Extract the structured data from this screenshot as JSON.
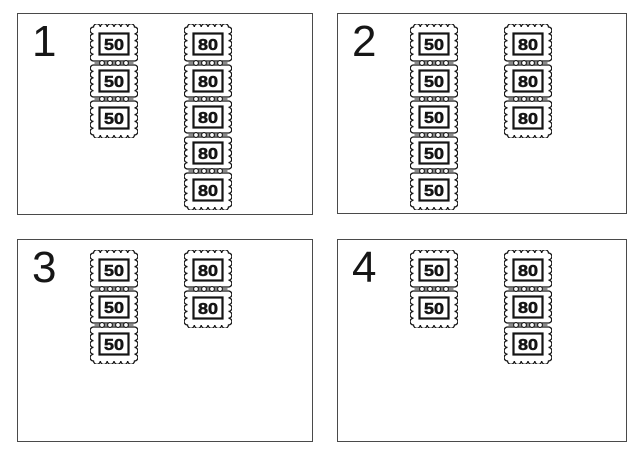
{
  "worksheet": {
    "background": "#ffffff",
    "ink_color": "#141414",
    "panel_border_color": "#4a4a4a",
    "stamp_values": [
      "50",
      "80"
    ]
  },
  "panels": [
    {
      "number": "1",
      "strips": [
        {
          "value": "50",
          "count": 3
        },
        {
          "value": "80",
          "count": 5
        }
      ]
    },
    {
      "number": "2",
      "strips": [
        {
          "value": "50",
          "count": 5
        },
        {
          "value": "80",
          "count": 3
        }
      ]
    },
    {
      "number": "3",
      "strips": [
        {
          "value": "50",
          "count": 3
        },
        {
          "value": "80",
          "count": 2
        }
      ]
    },
    {
      "number": "4",
      "strips": [
        {
          "value": "50",
          "count": 2
        },
        {
          "value": "80",
          "count": 3
        }
      ]
    }
  ]
}
